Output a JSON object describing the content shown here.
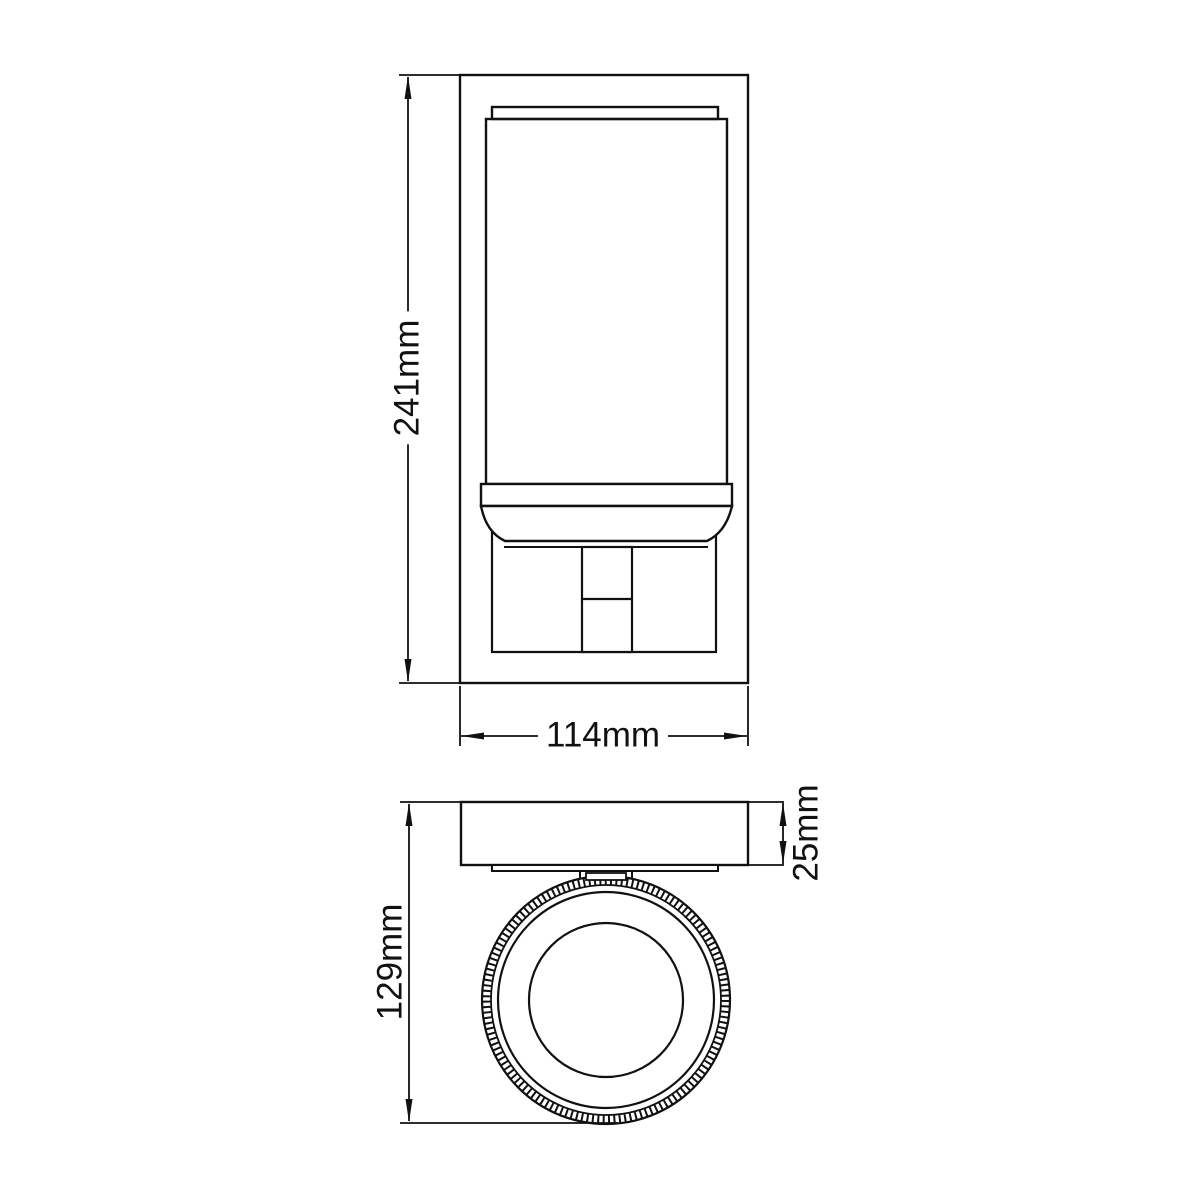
{
  "canvas": {
    "background": "#ffffff",
    "line_color": "#111111"
  },
  "diagram": {
    "dimensions": {
      "height": {
        "label": "241mm"
      },
      "width": {
        "label": "114mm"
      },
      "depth": {
        "label": "129mm"
      },
      "backplate_thickness": {
        "label": "25mm"
      }
    }
  }
}
